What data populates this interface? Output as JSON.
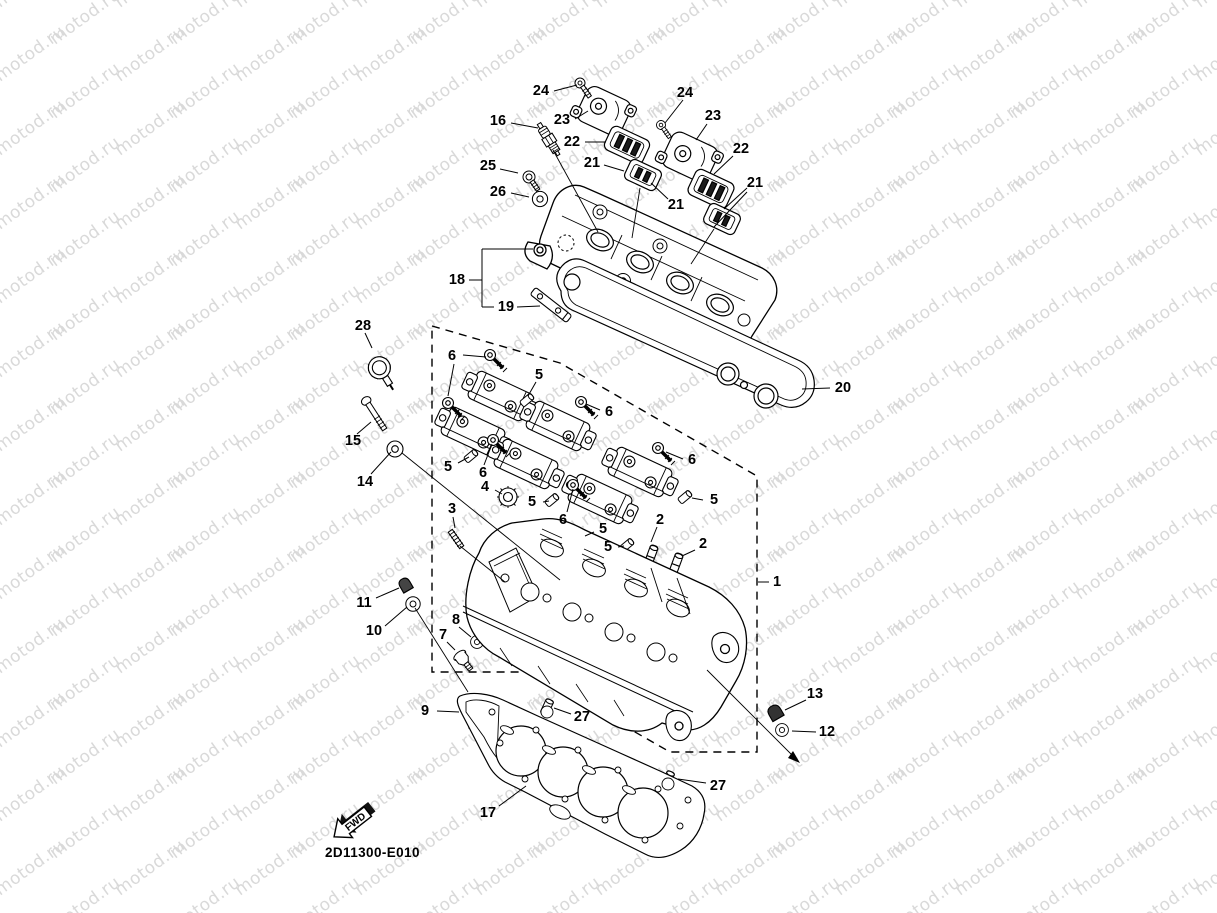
{
  "watermark": {
    "text": "motod.ru",
    "color": "#d9d9d9",
    "angle": -36,
    "x_step": 120,
    "y_step": 37,
    "x_stagger": 55,
    "cols": 12,
    "rows": 26
  },
  "drawing_code": "2D11300-E010",
  "fwd_label": "FWD",
  "colors": {
    "line": "#000000",
    "label": "#000000",
    "background": "#ffffff"
  },
  "callouts": [
    {
      "t": "24",
      "x": 541,
      "y": 91,
      "l": [
        [
          554,
          91,
          577,
          85
        ]
      ]
    },
    {
      "t": "23",
      "x": 562,
      "y": 120,
      "l": [
        [
          575,
          119,
          588,
          111
        ]
      ]
    },
    {
      "t": "16",
      "x": 498,
      "y": 121,
      "l": [
        [
          511,
          123,
          538,
          128
        ]
      ]
    },
    {
      "t": "24",
      "x": 685,
      "y": 93,
      "l": [
        [
          683,
          100,
          665,
          123
        ]
      ]
    },
    {
      "t": "23",
      "x": 713,
      "y": 116,
      "l": [
        [
          707,
          124,
          696,
          140
        ]
      ]
    },
    {
      "t": "22",
      "x": 572,
      "y": 142,
      "l": [
        [
          585,
          142,
          606,
          142
        ]
      ]
    },
    {
      "t": "22",
      "x": 741,
      "y": 149,
      "l": [
        [
          733,
          156,
          714,
          174
        ]
      ]
    },
    {
      "t": "21",
      "x": 592,
      "y": 163,
      "l": [
        [
          604,
          165,
          624,
          171
        ]
      ]
    },
    {
      "t": "25",
      "x": 488,
      "y": 166,
      "l": [
        [
          500,
          169,
          518,
          173
        ]
      ]
    },
    {
      "t": "26",
      "x": 498,
      "y": 192,
      "l": [
        [
          511,
          193,
          529,
          197
        ]
      ]
    },
    {
      "t": "21",
      "x": 676,
      "y": 205,
      "l": [
        [
          668,
          199,
          651,
          183
        ]
      ]
    },
    {
      "t": "21",
      "x": 755,
      "y": 183,
      "l": [
        [
          747,
          188,
          724,
          209
        ],
        [
          747,
          192,
          714,
          227
        ]
      ]
    },
    {
      "t": "18",
      "x": 457,
      "y": 280,
      "l": [
        [
          469,
          280,
          482,
          280
        ]
      ]
    },
    {
      "t": "19",
      "x": 506,
      "y": 307,
      "l": [
        [
          517,
          307,
          540,
          306
        ]
      ]
    },
    {
      "t": "28",
      "x": 363,
      "y": 326,
      "l": [
        [
          365,
          333,
          372,
          348
        ]
      ]
    },
    {
      "t": "6",
      "x": 452,
      "y": 356,
      "l": [
        [
          463,
          355,
          486,
          357
        ],
        [
          454,
          364,
          448,
          396
        ]
      ]
    },
    {
      "t": "5",
      "x": 539,
      "y": 375,
      "l": [
        [
          536,
          382,
          528,
          396
        ]
      ]
    },
    {
      "t": "20",
      "x": 843,
      "y": 388,
      "l": [
        [
          830,
          388,
          802,
          389
        ]
      ]
    },
    {
      "t": "6",
      "x": 609,
      "y": 412,
      "l": [
        [
          600,
          410,
          586,
          404
        ]
      ]
    },
    {
      "t": "15",
      "x": 353,
      "y": 441,
      "l": [
        [
          357,
          434,
          371,
          422
        ]
      ]
    },
    {
      "t": "5",
      "x": 448,
      "y": 467,
      "l": [
        [
          458,
          463,
          469,
          457
        ]
      ]
    },
    {
      "t": "6",
      "x": 692,
      "y": 460,
      "l": [
        [
          683,
          459,
          666,
          452
        ]
      ]
    },
    {
      "t": "6",
      "x": 483,
      "y": 473,
      "l": [
        [
          484,
          465,
          492,
          444
        ]
      ]
    },
    {
      "t": "14",
      "x": 365,
      "y": 482,
      "l": [
        [
          371,
          474,
          391,
          452
        ]
      ]
    },
    {
      "t": "4",
      "x": 485,
      "y": 487,
      "l": [
        [
          495,
          490,
          502,
          494
        ]
      ]
    },
    {
      "t": "5",
      "x": 714,
      "y": 500,
      "l": [
        [
          703,
          500,
          692,
          498
        ]
      ]
    },
    {
      "t": "5",
      "x": 532,
      "y": 502,
      "l": [
        [
          543,
          502,
          549,
          501
        ]
      ]
    },
    {
      "t": "3",
      "x": 452,
      "y": 509,
      "l": [
        [
          453,
          517,
          455,
          528
        ]
      ]
    },
    {
      "t": "6",
      "x": 563,
      "y": 520,
      "l": [
        [
          567,
          512,
          573,
          489
        ]
      ]
    },
    {
      "t": "2",
      "x": 660,
      "y": 520,
      "l": [
        [
          657,
          527,
          651,
          542
        ]
      ]
    },
    {
      "t": "5",
      "x": 603,
      "y": 529,
      "l": [
        [
          594,
          532,
          585,
          536
        ]
      ]
    },
    {
      "t": "2",
      "x": 703,
      "y": 544,
      "l": [
        [
          695,
          550,
          682,
          556
        ]
      ]
    },
    {
      "t": "5",
      "x": 608,
      "y": 547,
      "l": [
        [
          618,
          547,
          624,
          546
        ]
      ]
    },
    {
      "t": "1",
      "x": 777,
      "y": 582,
      "l": [
        [
          769,
          582,
          758,
          582
        ]
      ]
    },
    {
      "t": "11",
      "x": 364,
      "y": 603,
      "l": [
        [
          376,
          598,
          399,
          588
        ]
      ]
    },
    {
      "t": "8",
      "x": 456,
      "y": 620,
      "l": [
        [
          459,
          627,
          471,
          637
        ]
      ]
    },
    {
      "t": "10",
      "x": 374,
      "y": 631,
      "l": [
        [
          385,
          626,
          407,
          607
        ]
      ]
    },
    {
      "t": "7",
      "x": 443,
      "y": 635,
      "l": [
        [
          447,
          642,
          455,
          650
        ]
      ]
    },
    {
      "t": "13",
      "x": 815,
      "y": 694,
      "l": [
        [
          806,
          700,
          785,
          710
        ]
      ]
    },
    {
      "t": "9",
      "x": 425,
      "y": 711,
      "l": [
        [
          437,
          711,
          459,
          712
        ]
      ]
    },
    {
      "t": "27",
      "x": 582,
      "y": 717,
      "l": [
        [
          571,
          714,
          554,
          708
        ]
      ]
    },
    {
      "t": "12",
      "x": 827,
      "y": 732,
      "l": [
        [
          816,
          732,
          792,
          731
        ]
      ]
    },
    {
      "t": "27",
      "x": 718,
      "y": 786,
      "l": [
        [
          706,
          783,
          678,
          779
        ]
      ]
    },
    {
      "t": "17",
      "x": 488,
      "y": 813,
      "l": [
        [
          499,
          806,
          526,
          786
        ]
      ]
    }
  ]
}
